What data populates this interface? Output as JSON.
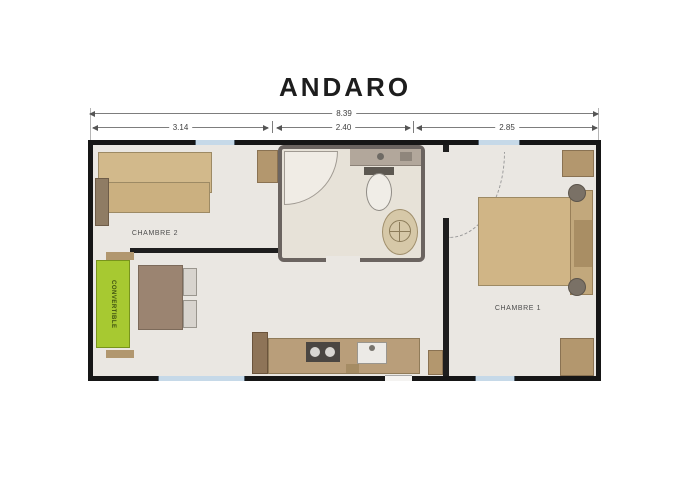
{
  "title": "ANDARO",
  "dimensions": {
    "total": "8.39",
    "segments": [
      "3.14",
      "2.40",
      "2.85"
    ]
  },
  "rooms": {
    "chambre2": "CHAMBRE 2",
    "chambre1": "CHAMBRE 1"
  },
  "furniture": {
    "sofa_label": "CONVERTIBLE"
  },
  "icons": {
    "shower": "corner-shower-icon",
    "toilet": "toilet-icon",
    "washbasin": "round-washbasin-icon",
    "hob": "two-burner-hob-icon",
    "sink": "kitchen-sink-icon"
  },
  "colors": {
    "wall": "#161616",
    "floor": "#eae7e2",
    "bathroom_wall": "#6b6460",
    "window_blue": "#c6d9e8",
    "wood_tan": "#d2b98b",
    "wardrobe_tan": "#b3976e",
    "counter": "#b99e7a",
    "table": "#9b8471",
    "sofa_green": "#a7c931"
  }
}
